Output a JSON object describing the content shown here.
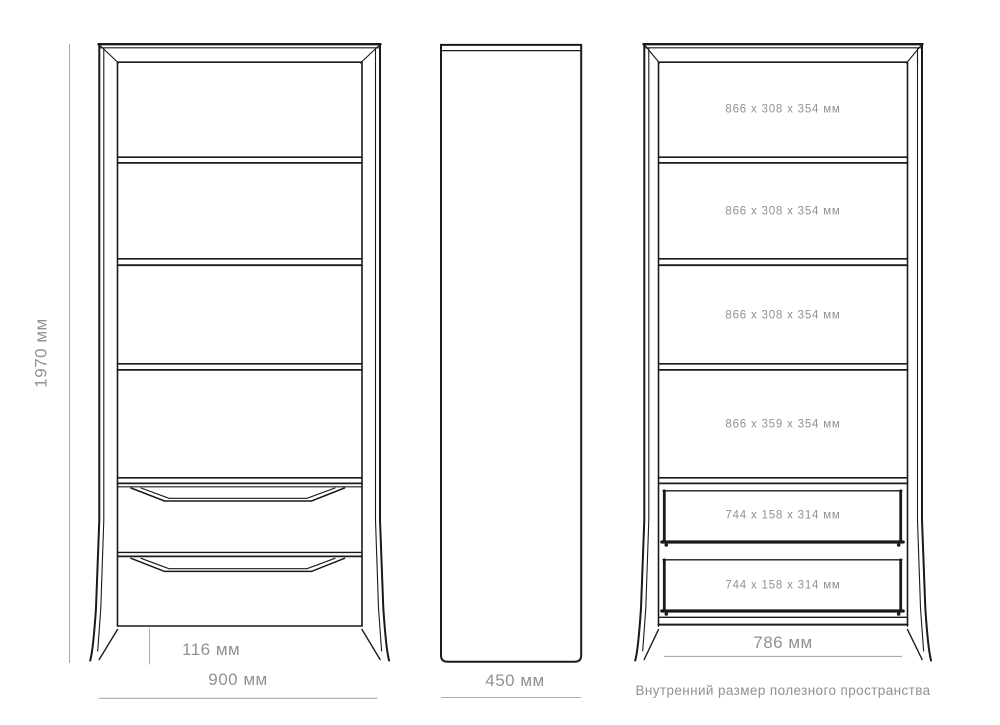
{
  "drawing_title": "Внутренний размер полезного пространства",
  "colors": {
    "ink": "#1a1a1a",
    "dimension_line": "#adadad",
    "label_text": "#8f9194"
  },
  "front_view": {
    "height_label": "1970 мм",
    "width_label": "900 мм",
    "plinth_label": "116 мм"
  },
  "side_view": {
    "depth_label": "450 мм"
  },
  "internal_view": {
    "shelf_labels": [
      "866 x 308 x 354 мм",
      "866 x 308 x 354 мм",
      "866 x 308 x 354 мм",
      "866 x 359 x 354 мм"
    ],
    "drawer_labels": [
      "744 x 158 x 314 мм",
      "744 x 158 x 314 мм"
    ],
    "inner_width_label": "786 мм",
    "caption": "Внутренний размер полезного пространства"
  }
}
